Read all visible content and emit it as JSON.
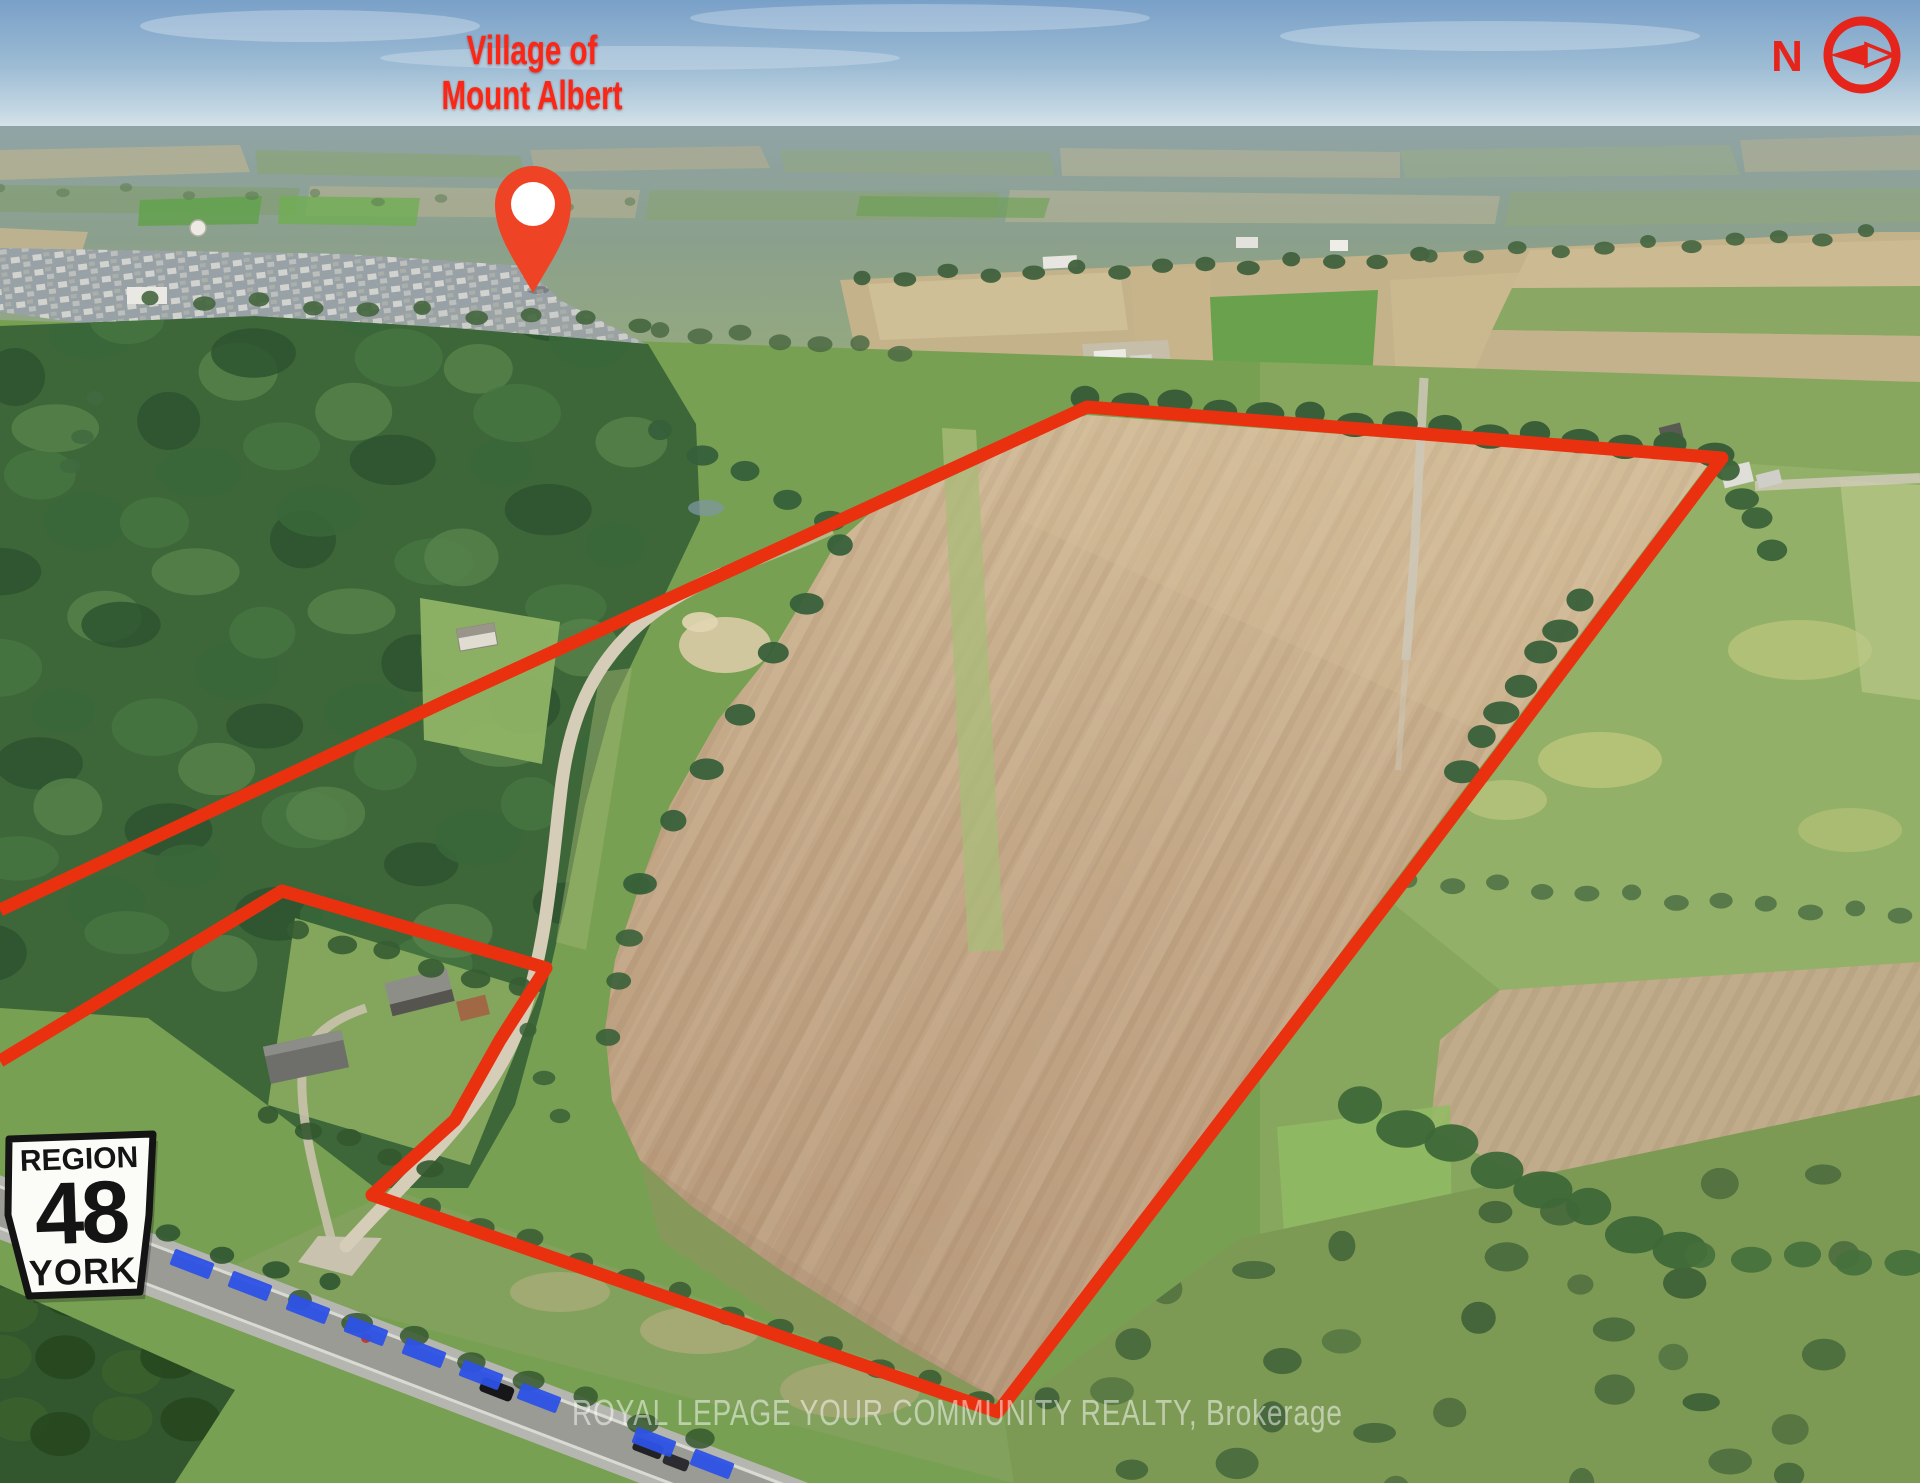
{
  "page": {
    "width": 1920,
    "height": 1483
  },
  "labels": {
    "village": {
      "line1": "Village of",
      "line2": "Mount Albert"
    },
    "compass": {
      "letter": "N"
    },
    "road_sign": {
      "region": "REGION",
      "number": "48",
      "name": "YORK"
    },
    "watermark": {
      "text": "ROYAL LEPAGE YOUR COMMUNITY REALTY, Brokerage"
    }
  },
  "colors": {
    "annotation_red": "#e93110",
    "label_red": "#fb2616",
    "dash_blue": "#2d52e6",
    "pin_red": "#ee4425",
    "sign_text": "#141414",
    "watermark_white": "rgba(255,255,255,0.5)"
  },
  "annotations": {
    "property_boundary": {
      "stroke_width": 13,
      "points": [
        [
          0,
          910
        ],
        [
          448,
          700
        ],
        [
          1087,
          407
        ],
        [
          1722,
          458
        ],
        [
          1410,
          873
        ],
        [
          998,
          1412
        ],
        [
          372,
          1195
        ],
        [
          455,
          1120
        ],
        [
          500,
          1040
        ],
        [
          546,
          968
        ],
        [
          282,
          891
        ],
        [
          0,
          1061
        ]
      ]
    },
    "highway_dashes": {
      "length": 42,
      "thickness": 17,
      "angle_deg": 21,
      "centers": [
        [
          192,
          1264
        ],
        [
          250,
          1286
        ],
        [
          308,
          1309
        ],
        [
          366,
          1331
        ],
        [
          424,
          1353
        ],
        [
          481,
          1375
        ],
        [
          539,
          1398
        ],
        [
          654,
          1442
        ],
        [
          712,
          1464
        ]
      ]
    },
    "location_pin": {
      "cx": 533,
      "cy": 204,
      "r_outer": 38,
      "r_inner": 22,
      "tip_y": 293
    }
  }
}
